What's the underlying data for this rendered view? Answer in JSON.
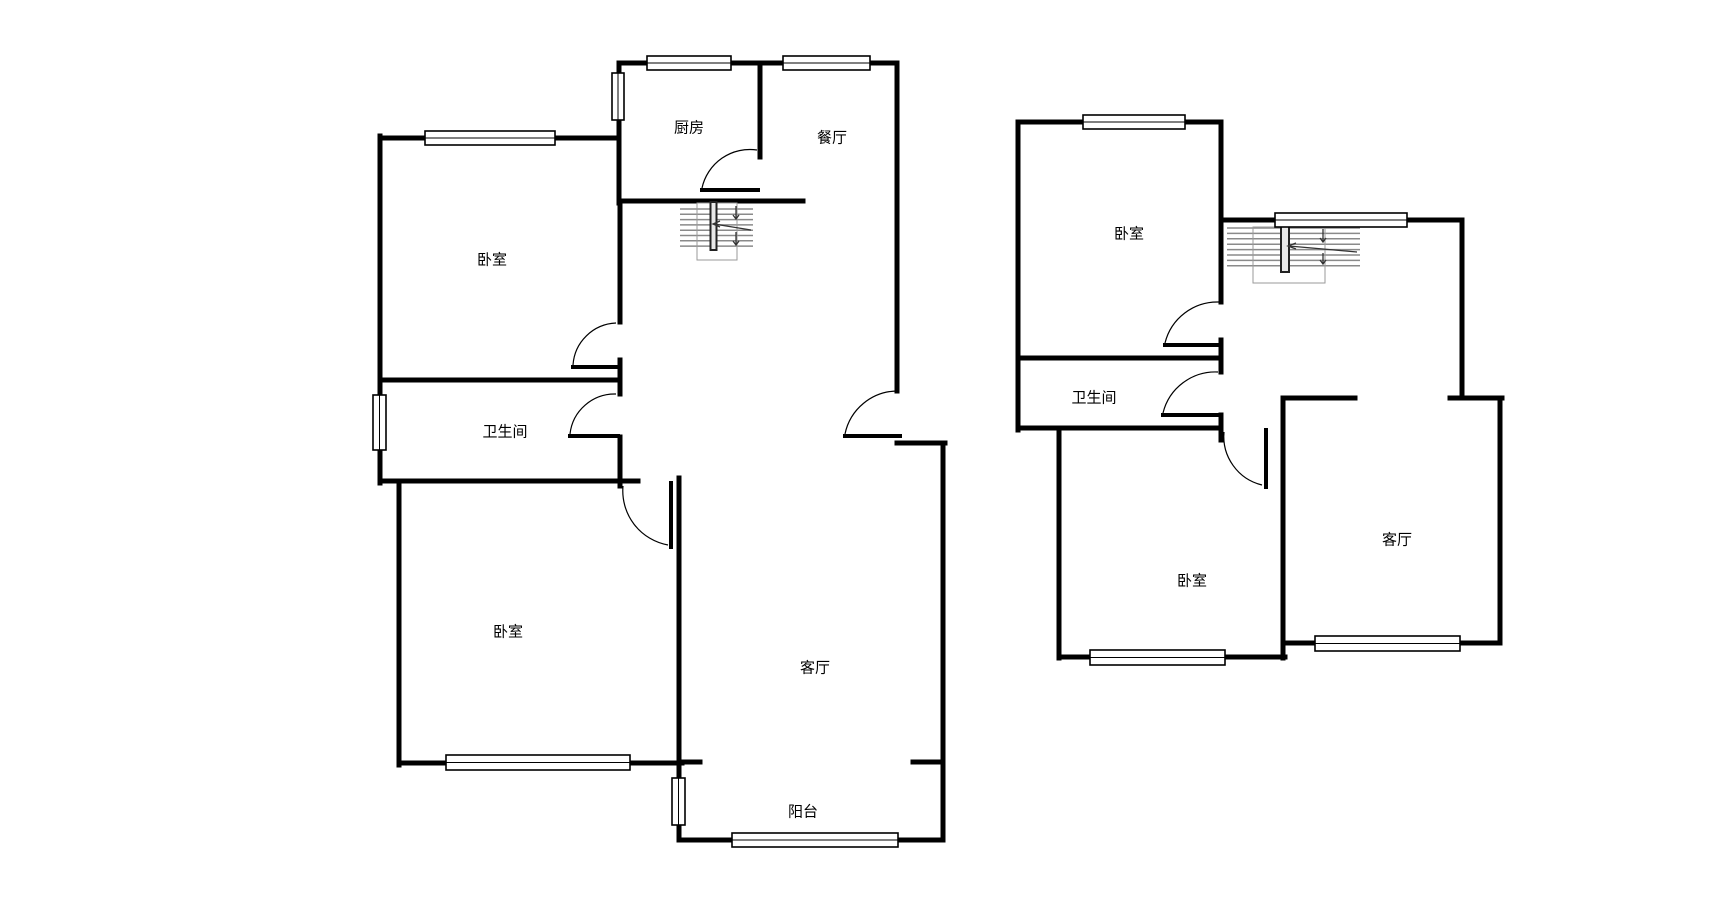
{
  "canvas": {
    "width": 1731,
    "height": 917,
    "background": "#ffffff"
  },
  "colors": {
    "wall": "#000000",
    "thin_line": "#000000",
    "window_fill": "#ffffff",
    "stair_tread": "#8a8a8a",
    "stair_outline": "#9a9a9a",
    "stair_rail_fill": "#e8e8e8",
    "stair_rail_stroke": "#222222",
    "arrow": "#333333",
    "label": "#000000"
  },
  "floor_plans": [
    {
      "name": "first-floor-plan",
      "labels": [
        {
          "name": "kitchen-label",
          "text": "厨房",
          "x": 689,
          "y": 128
        },
        {
          "name": "dining-room-label",
          "text": "餐厅",
          "x": 832,
          "y": 138
        },
        {
          "name": "bedroom-1-label",
          "text": "卧室",
          "x": 492,
          "y": 260
        },
        {
          "name": "bathroom-label",
          "text": "卫生间",
          "x": 505,
          "y": 432
        },
        {
          "name": "bedroom-2-label",
          "text": "卧室",
          "x": 508,
          "y": 632
        },
        {
          "name": "living-room-label",
          "text": "客厅",
          "x": 815,
          "y": 668
        },
        {
          "name": "balcony-label",
          "text": "阳台",
          "x": 803,
          "y": 812
        }
      ],
      "walls": [
        [
          619,
          63,
          897,
          63
        ],
        [
          897,
          63,
          897,
          391
        ],
        [
          897,
          443,
          945,
          443
        ],
        [
          943,
          443,
          943,
          840
        ],
        [
          913,
          762,
          943,
          762
        ],
        [
          679,
          840,
          943,
          840
        ],
        [
          679,
          762,
          679,
          840
        ],
        [
          679,
          762,
          700,
          762
        ],
        [
          399,
          763,
          682,
          763
        ],
        [
          399,
          481,
          399,
          765
        ],
        [
          380,
          378,
          380,
          483
        ],
        [
          380,
          136,
          380,
          382
        ],
        [
          380,
          138,
          619,
          138
        ],
        [
          619,
          63,
          619,
          203
        ],
        [
          620,
          201,
          620,
          322
        ],
        [
          620,
          360,
          620,
          394
        ],
        [
          620,
          437,
          620,
          486
        ],
        [
          380,
          380,
          618,
          380
        ],
        [
          380,
          481,
          638,
          481
        ],
        [
          760,
          63,
          760,
          157
        ],
        [
          620,
          201,
          803,
          201
        ],
        [
          679,
          478,
          679,
          763
        ]
      ],
      "windows": [
        {
          "x": 647,
          "y": 56,
          "w": 84,
          "h": 14,
          "orient": "h"
        },
        {
          "x": 783,
          "y": 56,
          "w": 87,
          "h": 14,
          "orient": "h"
        },
        {
          "x": 425,
          "y": 131,
          "w": 130,
          "h": 14,
          "orient": "h"
        },
        {
          "x": 612,
          "y": 73,
          "w": 12,
          "h": 47,
          "orient": "v"
        },
        {
          "x": 373,
          "y": 395,
          "w": 13,
          "h": 55,
          "orient": "v"
        },
        {
          "x": 446,
          "y": 755,
          "w": 184,
          "h": 15,
          "orient": "h"
        },
        {
          "x": 672,
          "y": 778,
          "w": 13,
          "h": 47,
          "orient": "v"
        },
        {
          "x": 732,
          "y": 833,
          "w": 166,
          "h": 14,
          "orient": "h"
        }
      ],
      "doors": [
        {
          "name": "entry-door",
          "leaf": [
            845,
            436,
            900,
            436
          ],
          "arc": "M 845 434 A 54 54 0 0 1 897 391"
        },
        {
          "name": "kitchen-door",
          "leaf": [
            702,
            190,
            758,
            190
          ],
          "arc": "M 702 188 A 49 49 0 0 1 757 150"
        },
        {
          "name": "bedroom-1-door",
          "leaf": [
            573,
            367,
            618,
            367
          ],
          "arc": "M 573 365 A 45 45 0 0 1 616 323"
        },
        {
          "name": "bathroom-door",
          "leaf": [
            570,
            436,
            618,
            436
          ],
          "arc": "M 570 434 A 45 45 0 0 1 616 394"
        },
        {
          "name": "bedroom-2-door",
          "leaf": [
            671,
            483,
            671,
            547
          ],
          "arc": "M 623 486 A 55 55 0 0 0 668 545"
        }
      ],
      "stairs": {
        "treads": {
          "x1": 680,
          "x2": 753,
          "y_start": 209,
          "count": 8,
          "step": 5.3
        },
        "rail": {
          "x": 710.5,
          "y": 202,
          "w": 6,
          "h": 48
        },
        "outline": {
          "x": 697,
          "y": 203,
          "w": 40,
          "h": 57
        },
        "arrows": [
          "M 736 206 L 736 218 M 733 215 L 736 219 L 739 215",
          "M 714 224 L 751 230 M 720 221 L 713 224 L 720 227",
          "M 736 232 L 736 244 M 733 241 L 736 245 L 739 241"
        ]
      }
    },
    {
      "name": "second-floor-plan",
      "labels": [
        {
          "name": "bedroom-1-label",
          "text": "卧室",
          "x": 1129,
          "y": 234
        },
        {
          "name": "bathroom-label",
          "text": "卫生间",
          "x": 1094,
          "y": 398
        },
        {
          "name": "bedroom-2-label",
          "text": "卧室",
          "x": 1192,
          "y": 581
        },
        {
          "name": "living-room-label",
          "text": "客厅",
          "x": 1397,
          "y": 540
        }
      ],
      "walls": [
        [
          1018,
          122,
          1220,
          122
        ],
        [
          1018,
          122,
          1018,
          430
        ],
        [
          1221,
          122,
          1221,
          302
        ],
        [
          1221,
          340,
          1221,
          372
        ],
        [
          1221,
          415,
          1221,
          440
        ],
        [
          1221,
          220,
          1462,
          220
        ],
        [
          1462,
          220,
          1462,
          398
        ],
        [
          1450,
          398,
          1502,
          398
        ],
        [
          1500,
          398,
          1500,
          643
        ],
        [
          1283,
          643,
          1500,
          643
        ],
        [
          1283,
          398,
          1283,
          658
        ],
        [
          1283,
          398,
          1355,
          398
        ],
        [
          1018,
          358,
          1218,
          358
        ],
        [
          1018,
          428,
          1221,
          428
        ],
        [
          1059,
          428,
          1059,
          658
        ],
        [
          1059,
          657,
          1285,
          657
        ]
      ],
      "windows": [
        {
          "x": 1083,
          "y": 115,
          "w": 102,
          "h": 14,
          "orient": "h"
        },
        {
          "x": 1275,
          "y": 213,
          "w": 132,
          "h": 14,
          "orient": "h"
        },
        {
          "x": 1090,
          "y": 650,
          "w": 135,
          "h": 15,
          "orient": "h"
        },
        {
          "x": 1315,
          "y": 636,
          "w": 145,
          "h": 15,
          "orient": "h"
        }
      ],
      "doors": [
        {
          "name": "bedroom-1-door",
          "leaf": [
            1165,
            345,
            1221,
            345
          ],
          "arc": "M 1165 343 A 54 54 0 0 1 1219 302"
        },
        {
          "name": "bathroom-door",
          "leaf": [
            1163,
            415,
            1218,
            415
          ],
          "arc": "M 1163 413 A 54 54 0 0 1 1218 372"
        },
        {
          "name": "bedroom-2-door",
          "leaf": [
            1266,
            430,
            1266,
            487
          ],
          "arc": "M 1224 432 A 50 50 0 0 0 1262 485"
        }
      ],
      "stairs": {
        "treads": {
          "x1": 1227,
          "x2": 1360,
          "y_start": 228,
          "count": 8,
          "step": 5.4
        },
        "rail": {
          "x": 1281,
          "y": 225,
          "w": 8,
          "h": 47
        },
        "outline": {
          "x": 1253,
          "y": 227,
          "w": 72,
          "h": 56
        },
        "arrows": [
          "M 1323 229 L 1323 241 M 1320 238 L 1323 242 L 1326 238",
          "M 1289 246 L 1357 252 M 1296 243 L 1288 246 L 1296 249",
          "M 1323 253 L 1323 263 M 1320 260 L 1323 264 L 1326 260"
        ]
      }
    }
  ]
}
